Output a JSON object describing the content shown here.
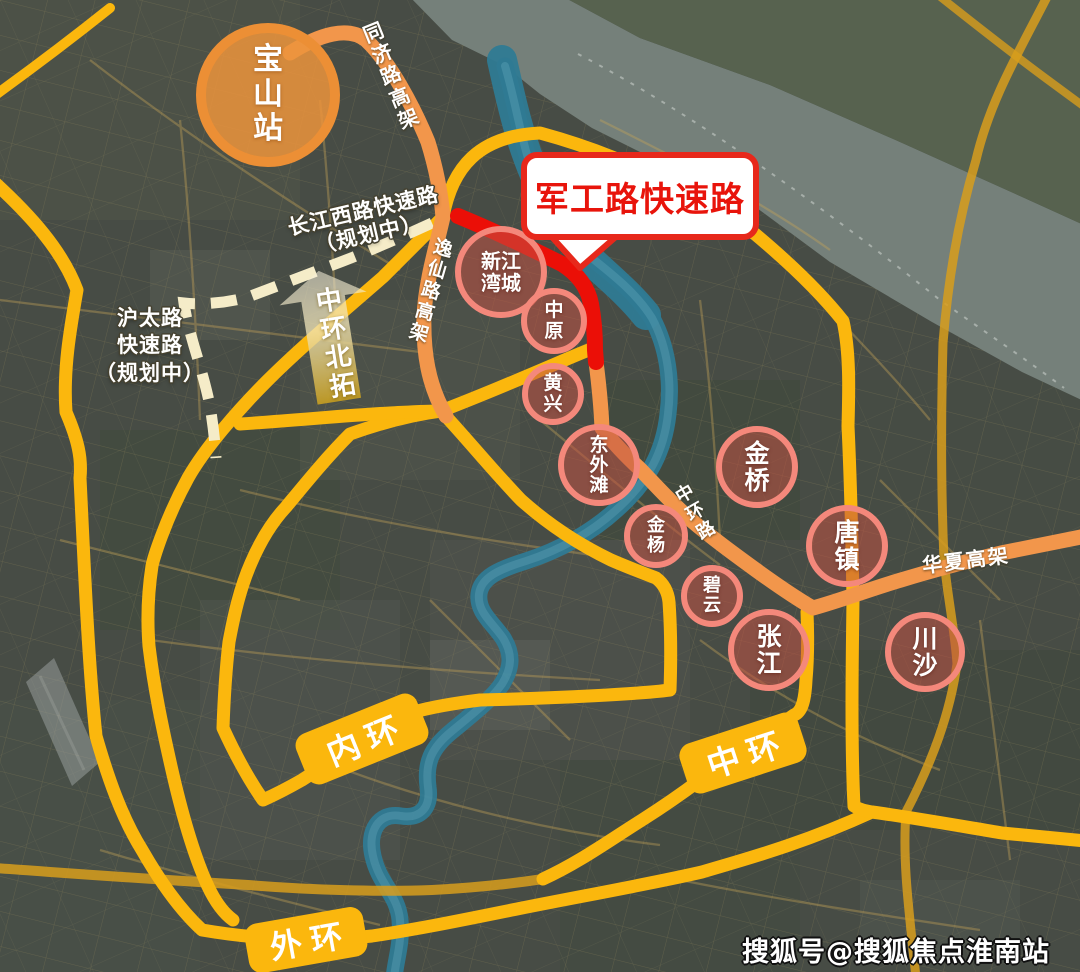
{
  "map": {
    "callout": {
      "label": "军工路快速路"
    },
    "hub": {
      "label": "宝山站"
    },
    "ring_labels": {
      "inner": "内环",
      "middle": "中环",
      "outer": "外环"
    },
    "road_labels": {
      "tongji": "同济路高架",
      "yixian": "逸仙路高架",
      "zhonghuan": "中环路",
      "huaxia": "华夏高架",
      "changjiang_planned": "长江西路快速路\n（规划中）",
      "hutai_planned": "沪太路\n快速路\n（规划中）"
    },
    "arrow_label": "中环北拓",
    "stations": {
      "xinjiangwancheng": "新江湾城",
      "zhongyuan": "中原",
      "huangxing": "黄兴",
      "dongwaitan": "东外滩",
      "jinyang": "金杨",
      "biyun": "碧云",
      "jinqiao": "金桥",
      "tangzhen": "唐镇",
      "zhangjiang": "张江",
      "chuansha": "川沙"
    },
    "watermark": "搜狐号@搜狐焦点淮南站",
    "colors": {
      "ring_yellow": "#FBB70D",
      "elevated_orange": "#F2964B",
      "highlight_red": "#EB0F07",
      "planned_cream": "#F5ECC8",
      "station_border": "#F4887B",
      "hub_orange": "#EC8F35",
      "river_teal": "#2F7A93",
      "secondary_gold": "#D89E1C"
    }
  }
}
